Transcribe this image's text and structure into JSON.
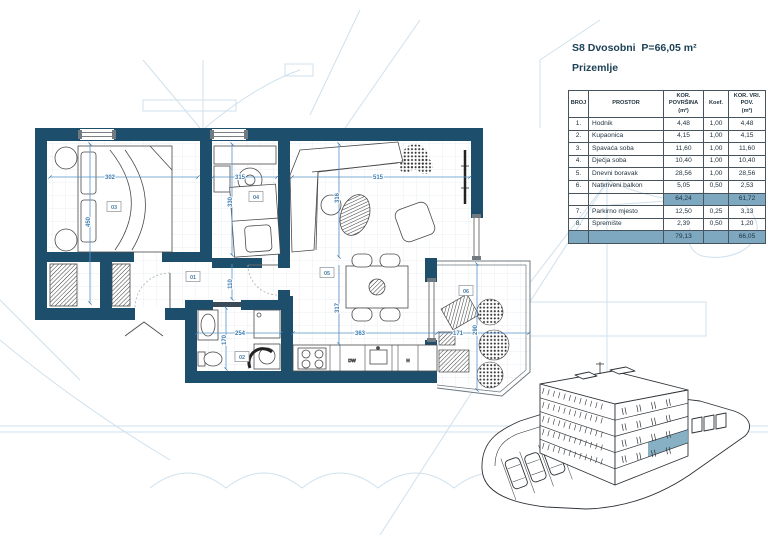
{
  "page": {
    "title": "S8 Dvosobni  P=66,05 m²",
    "subtitle": "Prizemlje"
  },
  "table": {
    "headers": {
      "broj": "BROJ",
      "prostor": "PROSTOR",
      "kor_povrsina": "KOR.\nPOVRŠINA\n(m²)",
      "koef": "Koef.",
      "kor_vri_pov": "KOR. VRI.\nPOV.\n(m²)"
    },
    "rows": [
      {
        "num": "1.",
        "name": "Hodnik",
        "area": "4,48",
        "koef": "1,00",
        "val": "4,48"
      },
      {
        "num": "2.",
        "name": "Kupaonica",
        "area": "4,15",
        "koef": "1,00",
        "val": "4,15"
      },
      {
        "num": "3.",
        "name": "Spavaća soba",
        "area": "11,60",
        "koef": "1,00",
        "val": "11,60"
      },
      {
        "num": "4.",
        "name": "Dječja soba",
        "area": "10,40",
        "koef": "1,00",
        "val": "10,40"
      },
      {
        "num": "5.",
        "name": "Dnevni boravak",
        "area": "28,56",
        "koef": "1,00",
        "val": "28,56"
      },
      {
        "num": "6.",
        "name": "Natkriveni balkon",
        "area": "5,05",
        "koef": "0,50",
        "val": "2,53"
      }
    ],
    "subtotal": {
      "area": "64,24",
      "val": "61,72"
    },
    "rows2": [
      {
        "num": "7.",
        "name": "Parkirno mjesto",
        "area": "12,50",
        "koef": "0,25",
        "val": "3,13"
      },
      {
        "num": "8.",
        "name": "Spremište",
        "area": "2,39",
        "koef": "0,50",
        "val": "1,20"
      }
    ],
    "total": {
      "area": "79,13",
      "val": "66,05"
    }
  },
  "plan": {
    "room_tags": {
      "hodnik": "01",
      "kupaonica": "02",
      "spavaca_soba": "03",
      "djecja_soba": "04",
      "dnevni_boravak": "05",
      "balkon": "06"
    },
    "dims": {
      "d302": "302",
      "d450": "450",
      "d315": "315",
      "d330": "330",
      "d110": "110",
      "d515": "515",
      "d316": "316",
      "d317": "317",
      "d363": "363",
      "d254": "254",
      "d170": "170",
      "d171": "171",
      "d290": "290"
    },
    "kitchen": {
      "dw": "DW",
      "h": "H"
    }
  },
  "colors": {
    "wall": "#1d4f6d",
    "table_highlight": "#7da8c0",
    "unit_highlight": "#7ba7bf",
    "dimension_blue": "#4b8fc7",
    "title_navy": "#1d4156",
    "faint_sketch": "#c7dbe9"
  }
}
